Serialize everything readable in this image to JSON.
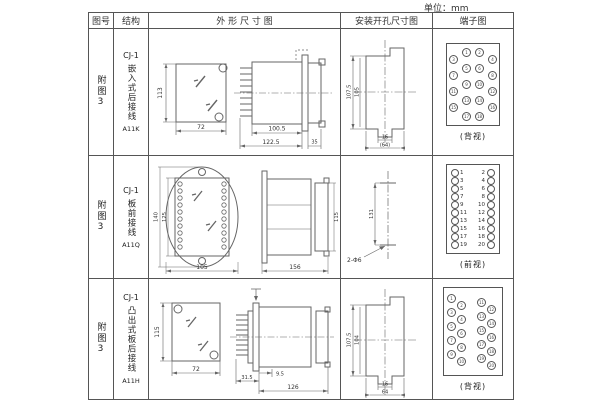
{
  "unit_label": "单位：mm",
  "table": {
    "headers": {
      "fig_no": "图号",
      "structure": "结构",
      "outline": "外 形 尺 寸 图",
      "install": "安装开孔尺寸图",
      "terminal": "端子图"
    },
    "rows": [
      {
        "fig_no": "附图3",
        "structure_model": "CJ-1",
        "structure_desc": "嵌入式后接线",
        "structure_code": "A11K",
        "outline_dims": {
          "front_height": "113",
          "front_width": "72",
          "body_len": "100.5",
          "total_len": "122.5",
          "bezel_depth": "35"
        },
        "install_dims": {
          "outer_h": "107.5",
          "inner_h": "105",
          "slot_w": "16",
          "span_w": "(64)"
        },
        "terminal_view_label": "(背视)",
        "terminals": [
          {
            "x": 15,
            "y": 4,
            "n": "1"
          },
          {
            "x": 28,
            "y": 4,
            "n": "2"
          },
          {
            "x": 2,
            "y": 11,
            "n": "3"
          },
          {
            "x": 41,
            "y": 11,
            "n": "4"
          },
          {
            "x": 15,
            "y": 20,
            "n": "5"
          },
          {
            "x": 28,
            "y": 20,
            "n": "6"
          },
          {
            "x": 2,
            "y": 27,
            "n": "7"
          },
          {
            "x": 41,
            "y": 27,
            "n": "8"
          },
          {
            "x": 15,
            "y": 36,
            "n": "9"
          },
          {
            "x": 28,
            "y": 36,
            "n": "10"
          },
          {
            "x": 2,
            "y": 43,
            "n": "11"
          },
          {
            "x": 41,
            "y": 43,
            "n": "12"
          },
          {
            "x": 15,
            "y": 52,
            "n": "13"
          },
          {
            "x": 28,
            "y": 52,
            "n": "14"
          },
          {
            "x": 2,
            "y": 59,
            "n": "15"
          },
          {
            "x": 41,
            "y": 59,
            "n": "16"
          },
          {
            "x": 15,
            "y": 68,
            "n": "17"
          },
          {
            "x": 28,
            "y": 68,
            "n": "18"
          }
        ]
      },
      {
        "fig_no": "附图3",
        "structure_model": "CJ-1",
        "structure_desc": "板前接线",
        "structure_code": "A11Q",
        "outline_dims": {
          "outer_h": "140",
          "inner_h": "125",
          "width": "105",
          "side_len": "156",
          "side_h": "115"
        },
        "install_dims": {
          "height": "131",
          "holes": "2-Φ6"
        },
        "terminal_view_label": "(前视)",
        "terminal_numbers_left": "1\n3\n5\n7\n9\n11\n13\n15\n17\n19",
        "terminal_numbers_right": "2\n4\n6\n8\n10\n12\n14\n16\n18\n20",
        "terminals": [
          {
            "x": 4,
            "y": 4
          },
          {
            "x": 4,
            "y": 12
          },
          {
            "x": 4,
            "y": 20
          },
          {
            "x": 4,
            "y": 28
          },
          {
            "x": 4,
            "y": 36
          },
          {
            "x": 4,
            "y": 44
          },
          {
            "x": 4,
            "y": 52
          },
          {
            "x": 4,
            "y": 60
          },
          {
            "x": 4,
            "y": 68
          },
          {
            "x": 4,
            "y": 76
          },
          {
            "x": 40,
            "y": 4
          },
          {
            "x": 40,
            "y": 12
          },
          {
            "x": 40,
            "y": 20
          },
          {
            "x": 40,
            "y": 28
          },
          {
            "x": 40,
            "y": 36
          },
          {
            "x": 40,
            "y": 44
          },
          {
            "x": 40,
            "y": 52
          },
          {
            "x": 40,
            "y": 60
          },
          {
            "x": 40,
            "y": 68
          },
          {
            "x": 40,
            "y": 76
          }
        ]
      },
      {
        "fig_no": "附图3",
        "structure_model": "CJ-1",
        "structure_desc": "凸出式板后接线",
        "structure_code": "A11H",
        "outline_dims": {
          "front_height": "115",
          "front_width": "72",
          "fin_len": "31.5",
          "gap": "9.5",
          "body_len": "126"
        },
        "install_dims": {
          "outer_h": "107.5",
          "inner_h": "104",
          "slot_w": "16",
          "span_w": "64"
        },
        "terminal_view_label": "(背视)",
        "terminals": [
          {
            "x": 3,
            "y": 6,
            "n": "1"
          },
          {
            "x": 13,
            "y": 13,
            "n": "2"
          },
          {
            "x": 3,
            "y": 20,
            "n": "3"
          },
          {
            "x": 13,
            "y": 27,
            "n": "4"
          },
          {
            "x": 3,
            "y": 34,
            "n": "5"
          },
          {
            "x": 13,
            "y": 41,
            "n": "6"
          },
          {
            "x": 3,
            "y": 48,
            "n": "7"
          },
          {
            "x": 13,
            "y": 55,
            "n": "8"
          },
          {
            "x": 3,
            "y": 62,
            "n": "9"
          },
          {
            "x": 13,
            "y": 69,
            "n": "10"
          },
          {
            "x": 33,
            "y": 10,
            "n": "11"
          },
          {
            "x": 43,
            "y": 17,
            "n": "12"
          },
          {
            "x": 33,
            "y": 24,
            "n": "13"
          },
          {
            "x": 43,
            "y": 31,
            "n": "14"
          },
          {
            "x": 33,
            "y": 38,
            "n": "15"
          },
          {
            "x": 43,
            "y": 45,
            "n": "16"
          },
          {
            "x": 33,
            "y": 52,
            "n": "17"
          },
          {
            "x": 43,
            "y": 59,
            "n": "18"
          },
          {
            "x": 33,
            "y": 66,
            "n": "19"
          },
          {
            "x": 43,
            "y": 73,
            "n": "20"
          }
        ]
      }
    ]
  }
}
